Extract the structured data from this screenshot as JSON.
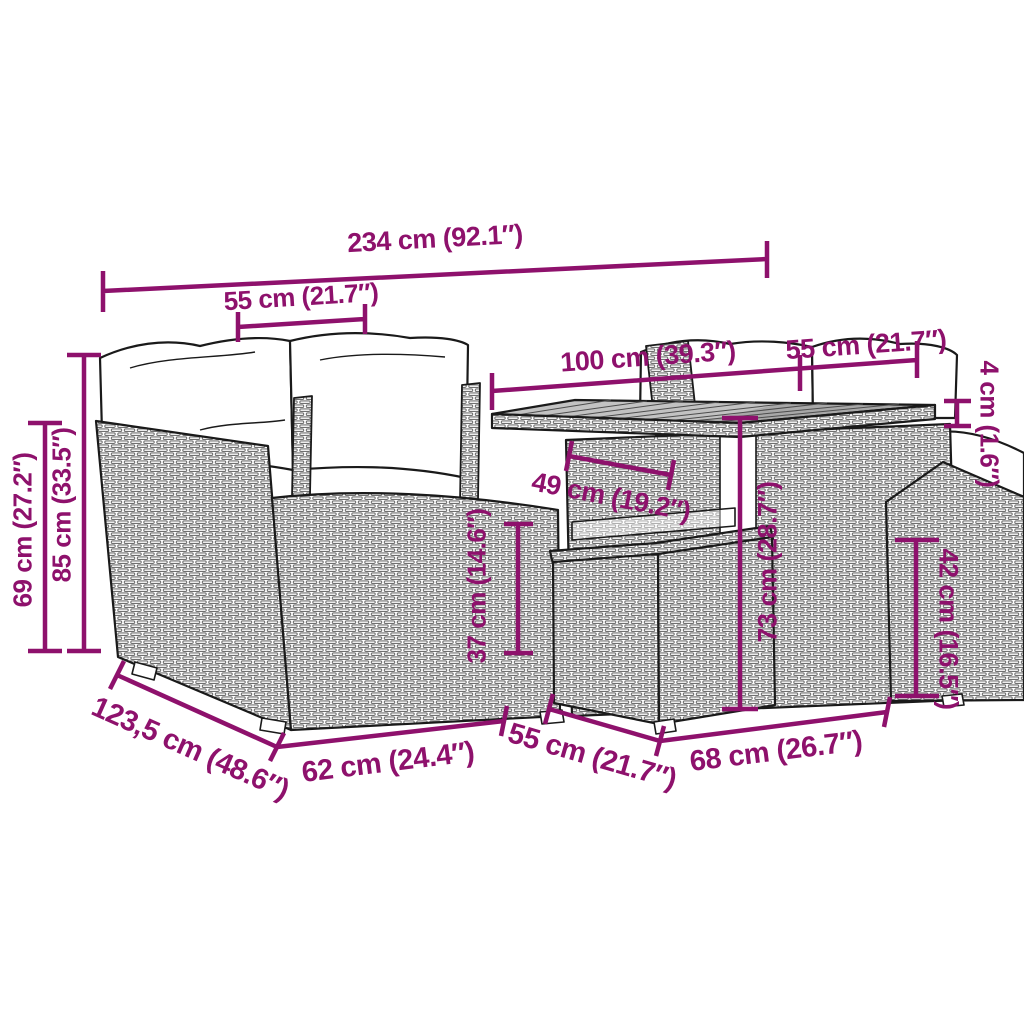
{
  "diagram": {
    "colors": {
      "dimension_accent": "#8E116C",
      "line_art": "#1a1a1a",
      "rattan_weave": "#707070",
      "tabletop_gray": "#c2c2c2",
      "cushion_white": "#ffffff"
    }
  },
  "dimensions": {
    "overall_width": "234 cm (92.1″)",
    "left_backrest_width": "55 cm (21.7″)",
    "table_width": "100 cm (39.3″)",
    "right_backrest_width": "55 cm (21.7″)",
    "tabletop_thickness": "4 cm (1.6″)",
    "armrest_height": "69 cm (27.2″)",
    "total_height": "85 cm (33.5″)",
    "table_inner_depth": "49 cm (19.2″)",
    "ottoman_height": "37 cm (14.6″)",
    "table_height": "73 cm (28.7″)",
    "right_seat_height": "42 cm (16.5″)",
    "sofa_depth": "123,5 cm (48.6″)",
    "seat_width": "62 cm (24.4″)",
    "ottoman_width": "55 cm (21.7″)",
    "table_depth": "68 cm (26.7″)"
  }
}
